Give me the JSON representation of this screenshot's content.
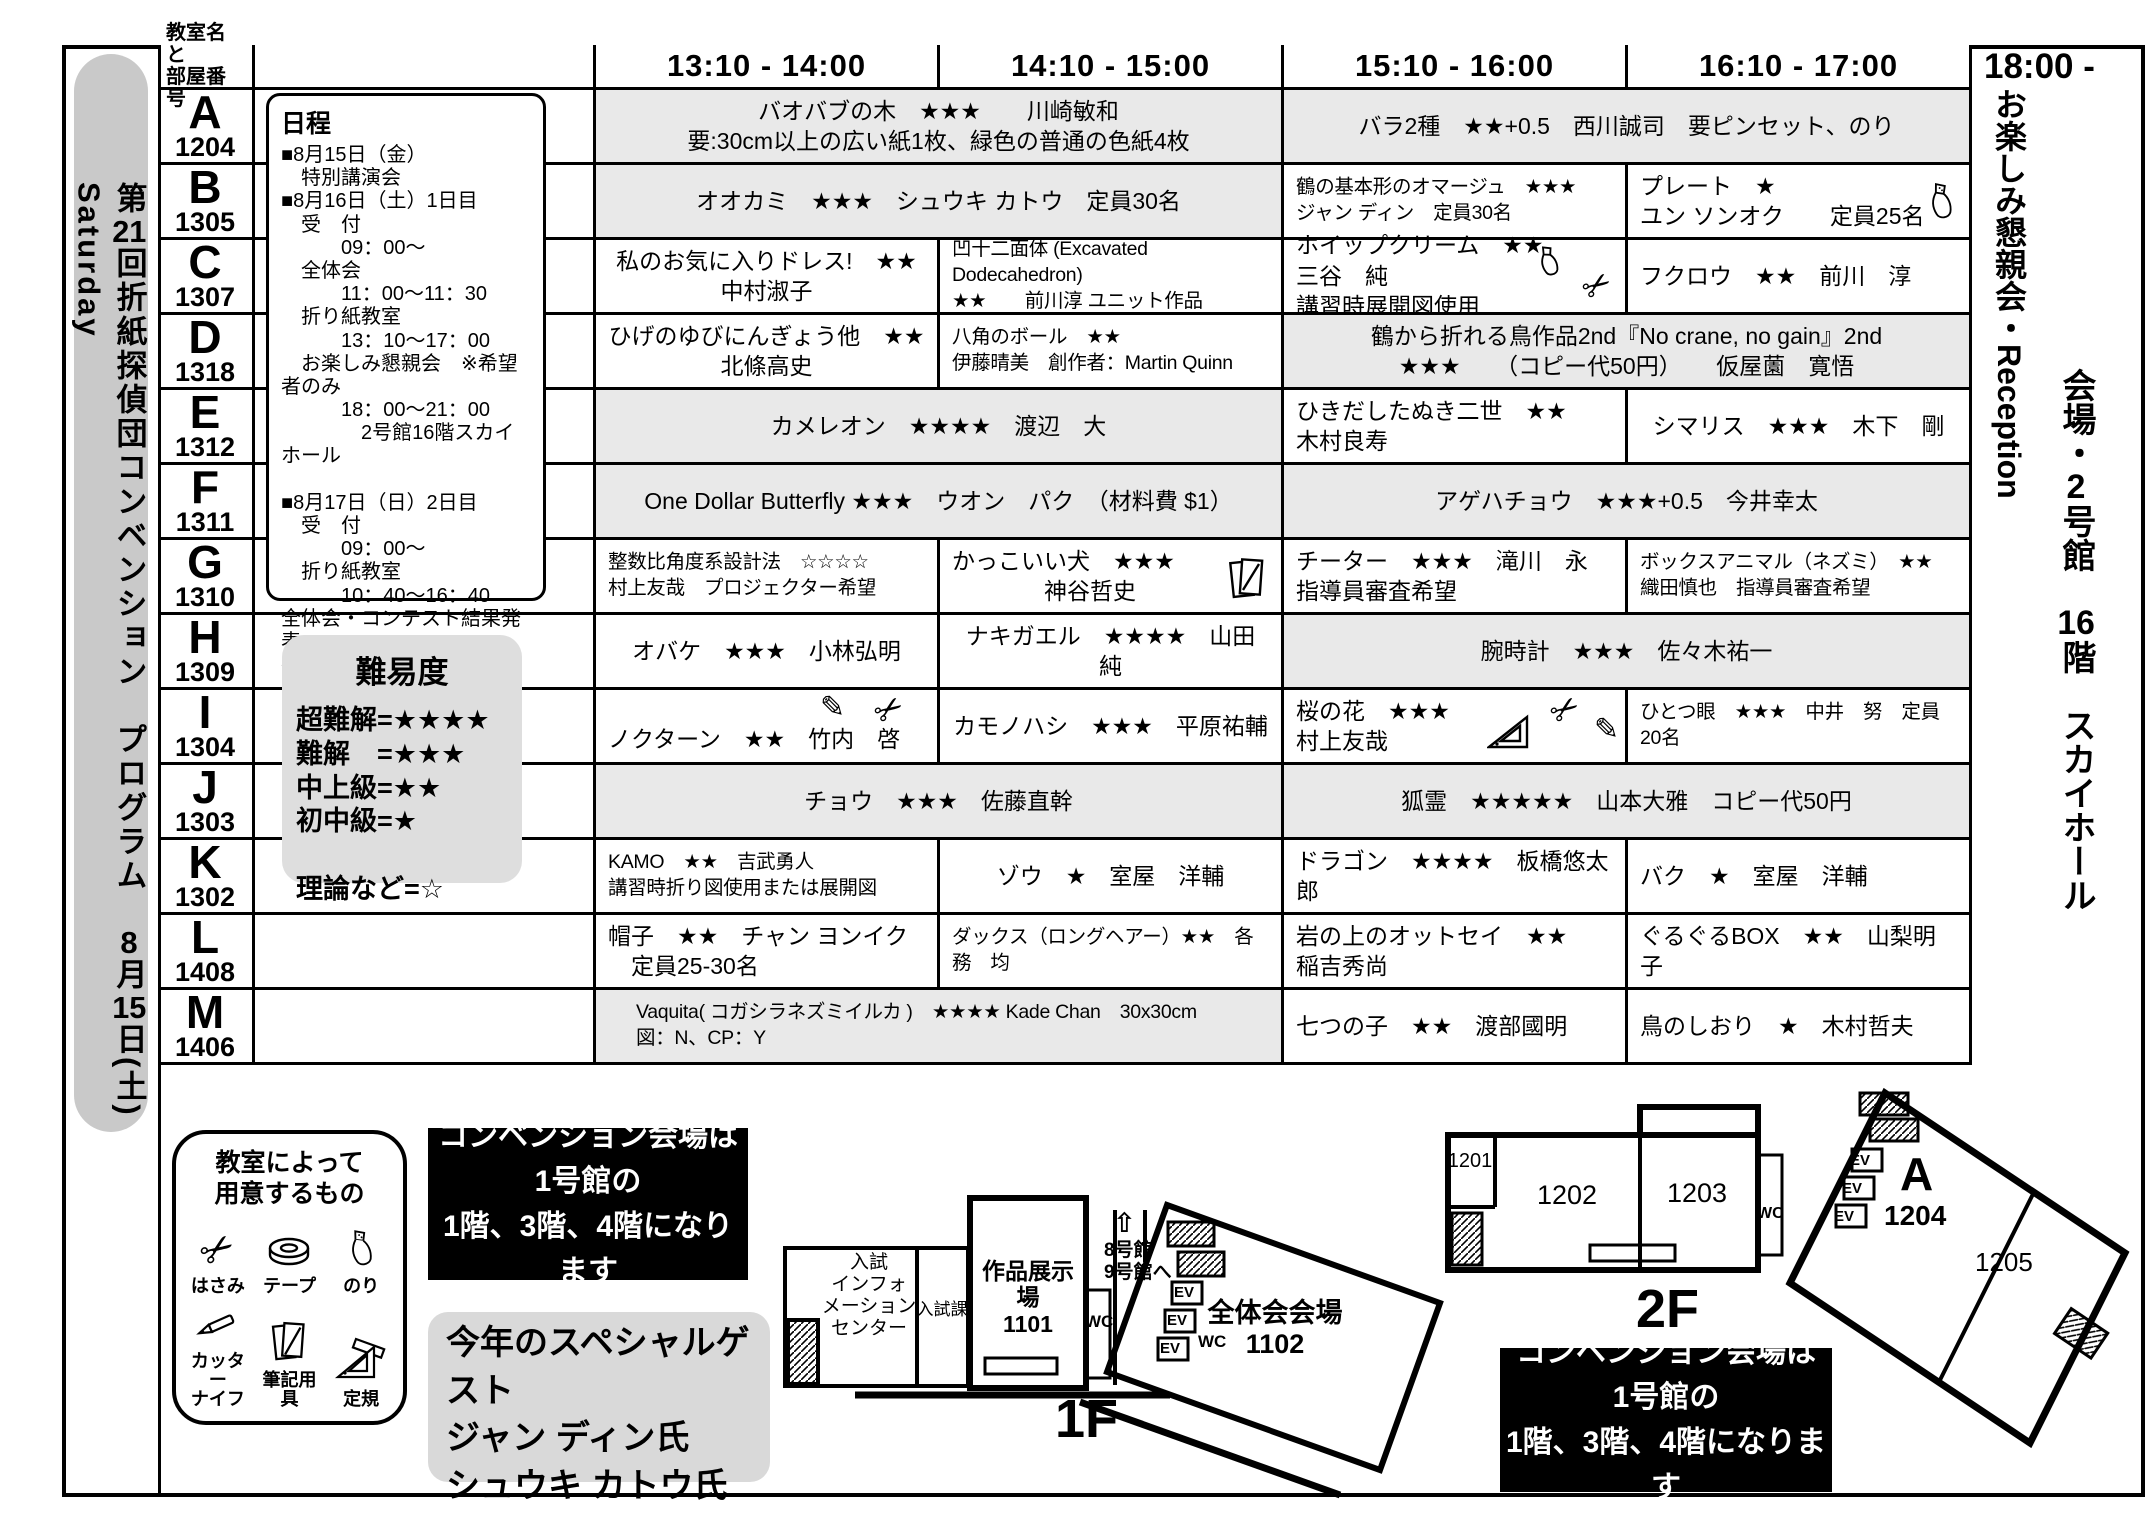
{
  "doc": {
    "side_title": {
      "parts": [
        "第",
        "21",
        "回折紙探偵団コンベンション　プログラム　",
        "8",
        "月",
        "15",
        "日(土)　",
        "Saturday"
      ]
    }
  },
  "header": {
    "room_col": "教室名と\n部屋番号",
    "slots": [
      "13:10 - 14:00",
      "14:10 - 15:00",
      "15:10 - 16:00",
      "16:10 - 17:00"
    ],
    "evening": "18:00 -"
  },
  "right_panel": {
    "reception": {
      "parts": [
        "お楽しみ懇親会・",
        "Reception"
      ]
    },
    "venue": {
      "parts": [
        "会場・",
        "2",
        "号館　",
        "16",
        "階　スカイホール"
      ]
    }
  },
  "schedule_box": {
    "title": "日程",
    "body": "■8月15日（金）\n　特別講演会\n■8月16日（土）1日目\n　受　付\n　　　09：00～\n　全体会\n　　　11：00～11：30\n　折り紙教室\n　　　13：10～17：00\n　お楽しみ懇親会　※希望者のみ\n　　　18：00～21：00\n　　　　2号館16階スカイホール\n\n■8月17日（日）2日目\n　受　付\n　　　09：00～\n　折り紙教室\n　　　10：40～16：40\n全体会・コンテスト結果発表\n折り紙アイテムオークション\n　　　16：50～"
  },
  "difficulty_box": {
    "title": "難易度",
    "body": "超難解=★★★★\n難解　=★★★\n中上級=★★\n初中級=★\n\n理論など=☆"
  },
  "rows": [
    {
      "letter": "A",
      "number": "1204",
      "cells": [
        {
          "text": "バオバブの木　★★★　　川崎敏和\n要:30cm以上の広い紙1枚、緑色の普通の色紙4枚",
          "icons": []
        },
        {
          "text": "バラ2種　★★+0.5　西川誠司　要ピンセット、のり",
          "icons": []
        }
      ]
    },
    {
      "letter": "B",
      "number": "1305",
      "cells": [
        {
          "text": "オオカミ　★★★　シュウキ カトウ　定員30名",
          "icons": []
        },
        {
          "text": "鶴の基本形のオマージュ　★★★\nジャン ディン　定員30名",
          "icons": []
        },
        {
          "text": "プレート　★\nユン ソンオク　　定員25名",
          "icons": [
            "glue"
          ]
        }
      ]
    },
    {
      "letter": "C",
      "number": "1307",
      "cells": [
        {
          "text": "私のお気に入りドレス!　★★\n中村淑子",
          "icons": []
        },
        {
          "text": "凹十二面体 (Excavated Dodecahedron)\n★★　　前川淳 ユニット作品",
          "icons": []
        },
        {
          "text": "ホイップクリーム　★★\n三谷　純\n講習時展開図使用",
          "icons": [
            "glue",
            "scissors"
          ]
        },
        {
          "text": "フクロウ　★★　前川　淳",
          "icons": []
        }
      ]
    },
    {
      "letter": "D",
      "number": "1318",
      "cells": [
        {
          "text": "ひげのゆびにんぎょう他　★★\n北條高史",
          "icons": []
        },
        {
          "text": "八角のボール　★★\n伊藤晴美　創作者：Martin Quinn",
          "icons": []
        },
        {
          "text": "鶴から折れる鳥作品2nd『No crane, no gain』2nd\n★★★　　（コピー代50円）　　仮屋薗　寛悟",
          "icons": []
        }
      ]
    },
    {
      "letter": "E",
      "number": "1312",
      "cells": [
        {
          "text": "カメレオン　★★★★　渡辺　大",
          "icons": []
        },
        {
          "text": "ひきだしたぬき二世　★★\n木村良寿",
          "icons": []
        },
        {
          "text": "シマリス　★★★　木下　剛",
          "icons": []
        }
      ]
    },
    {
      "letter": "F",
      "number": "1311",
      "cells": [
        {
          "text": "One Dollar Butterfly ★★★　ウオン　パク　（材料費 $1）",
          "icons": []
        },
        {
          "text": "アゲハチョウ　★★★+0.5　今井幸太",
          "icons": []
        }
      ]
    },
    {
      "letter": "G",
      "number": "1310",
      "cells": [
        {
          "text": "整数比角度系設計法　☆☆☆☆\n村上友哉　プロジェクター希望",
          "icons": []
        },
        {
          "text": "かっこいい犬　★★★\n　　　　神谷哲史",
          "icons": [
            "notepad"
          ]
        },
        {
          "text": "チーター　★★★　滝川　永\n指導員審査希望",
          "icons": []
        },
        {
          "text": "ボックスアニマル（ネズミ）　★★\n織田慎也　指導員審査希望",
          "icons": []
        }
      ]
    },
    {
      "letter": "H",
      "number": "1309",
      "cells": [
        {
          "text": "オバケ　★★★　小林弘明",
          "icons": []
        },
        {
          "text": "ナキガエル　★★★★　山田　純",
          "icons": []
        },
        {
          "text": "腕時計　★★★　佐々木祐一",
          "icons": []
        }
      ]
    },
    {
      "letter": "I",
      "number": "1304",
      "cells": [
        {
          "text": "ノクターン　★★　竹内　啓",
          "icons": [
            "pencil",
            "scissors"
          ]
        },
        {
          "text": "カモノハシ　★★★　平原祐輔",
          "icons": []
        },
        {
          "text": "桜の花　★★★\n村上友哉",
          "icons": [
            "set-square",
            "scissors",
            "pencil"
          ]
        },
        {
          "text": "ひとつ眼　★★★　中井　努　定員20名",
          "icons": []
        }
      ]
    },
    {
      "letter": "J",
      "number": "1303",
      "cells": [
        {
          "text": "チョウ　★★★　佐藤直幹",
          "icons": []
        },
        {
          "text": "狐霊　★★★★★　山本大雅　コピー代50円",
          "icons": []
        }
      ]
    },
    {
      "letter": "K",
      "number": "1302",
      "cells": [
        {
          "text": "KAMO　★★　吉武勇人\n講習時折り図使用または展開図",
          "icons": []
        },
        {
          "text": "ゾウ　★　室屋　洋輔",
          "icons": []
        },
        {
          "text": "ドラゴン　★★★★　板橋悠太郎",
          "icons": []
        },
        {
          "text": "バク　★　室屋　洋輔",
          "icons": []
        }
      ]
    },
    {
      "letter": "L",
      "number": "1408",
      "cells": [
        {
          "text": "帽子　★★　チャン ヨンイク\n　定員25-30名",
          "icons": []
        },
        {
          "text": "ダックス（ロングヘアー）★★　各務　均",
          "icons": []
        },
        {
          "text": "岩の上のオットセイ　★★\n稲吉秀尚",
          "icons": []
        },
        {
          "text": "ぐるぐるBOX　★★　山梨明子",
          "icons": []
        }
      ]
    },
    {
      "letter": "M",
      "number": "1406",
      "cells": [
        {
          "text": "Vaquita( コガシラネズミイルカ )　★★★★ Kade Chan　30x30cm\n図：N、CP：Y",
          "icons": []
        },
        {
          "text": "七つの子　★★　渡部國明",
          "icons": []
        },
        {
          "text": "鳥のしおり　★　木村哲夫",
          "icons": []
        }
      ]
    }
  ],
  "supplies_box": {
    "title": "教室によって\n用意するもの",
    "items": [
      "はさみ",
      "テープ",
      "のり",
      "カッター\nナイフ",
      "筆記用具",
      "定規"
    ]
  },
  "notices": {
    "venue": "コンベンション会場は\n1号館の\n1階、3階、4階になります"
  },
  "special_guest": {
    "text": "今年のスペシャルゲスト\nジャン ディン氏\nシュウキ カトウ氏"
  },
  "map_1f": {
    "label": "1F",
    "info": "入試\nインフォ\nメーション\nセンター",
    "admissions": "入試課",
    "exhibit": "作品展示場\n1101",
    "wc": "WC",
    "arrow": "⇧",
    "to_bldg": "8号館\n9号館へ",
    "ev": "EV",
    "hall": "全体会会場\n1102"
  },
  "map_2f": {
    "label": "2F",
    "r1201": "1201",
    "r1202": "1202",
    "r1203": "1203",
    "wc": "WC",
    "ev": "EV",
    "a_letter": "A",
    "a_number": "1204",
    "r1205": "1205"
  }
}
